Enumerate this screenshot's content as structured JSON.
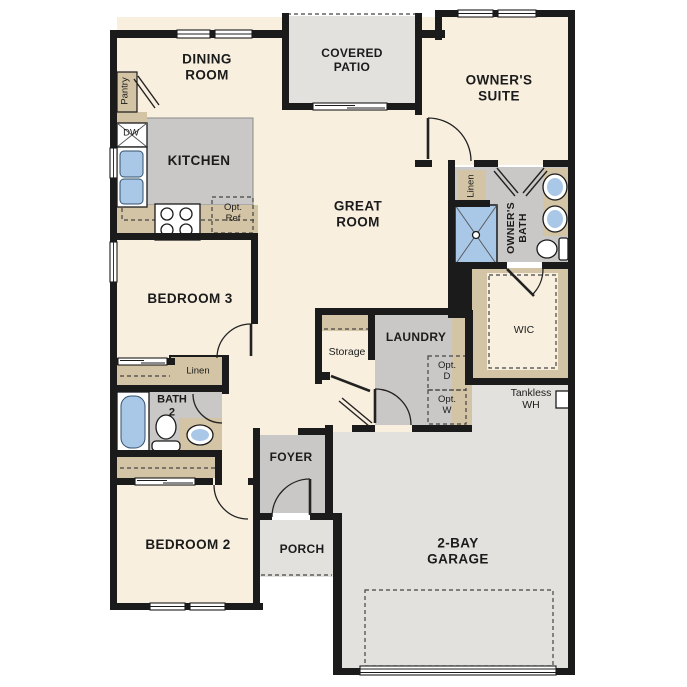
{
  "colors": {
    "wall": "#1b1b1b",
    "floor": "#f8efdf",
    "outdoor": "#e2e1dd",
    "room_gray": "#c9c8c6",
    "counter": "#d3c4a5",
    "fixture_blue": "#a9c7e6",
    "background": "#ffffff"
  },
  "labels": {
    "dining_room": [
      "DINING",
      "ROOM"
    ],
    "covered_patio": [
      "COVERED",
      "PATIO"
    ],
    "owners_suite": [
      "OWNER'S",
      "SUITE"
    ],
    "great_room": [
      "GREAT",
      "ROOM"
    ],
    "kitchen": "KITCHEN",
    "pantry": "Pantry",
    "dw": "DW",
    "opt_ref": [
      "Opt.",
      "Ref"
    ],
    "bedroom_3": "BEDROOM 3",
    "bedroom_2": "BEDROOM 2",
    "bath_2": [
      "BATH",
      "2"
    ],
    "linen_hall": "Linen",
    "linen_owner": "Linen",
    "owners_bath": [
      "OWNER'S",
      "BATH"
    ],
    "wic": "WIC",
    "storage": "Storage",
    "laundry": "LAUNDRY",
    "opt_d": [
      "Opt.",
      "D"
    ],
    "opt_w": [
      "Opt.",
      "W"
    ],
    "foyer": "FOYER",
    "porch": "PORCH",
    "garage": [
      "2-BAY",
      "GARAGE"
    ],
    "tankless_wh": [
      "Tankless",
      "WH"
    ]
  }
}
